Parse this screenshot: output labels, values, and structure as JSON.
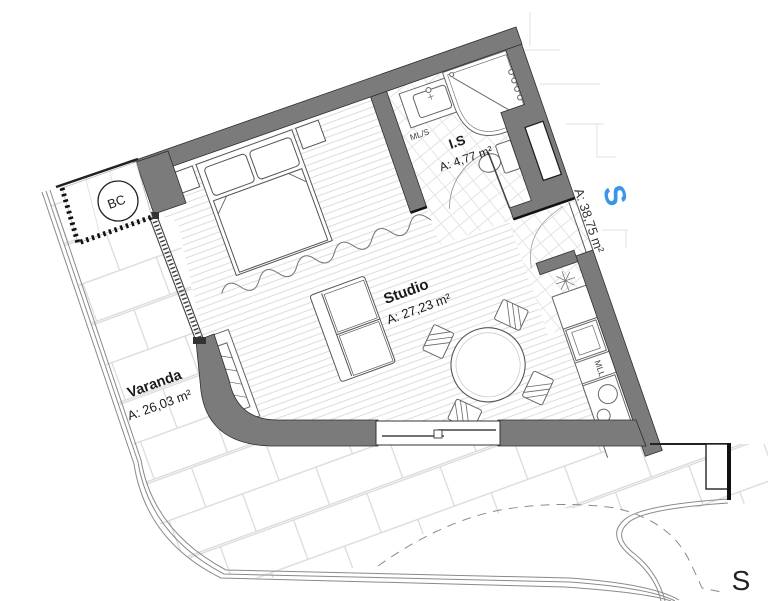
{
  "plan": {
    "rooms": {
      "studio": {
        "name": "Studio",
        "area": "A: 27,23 m²"
      },
      "bathroom": {
        "name": "I.S",
        "area": "A: 4,77 m²"
      },
      "balcony": {
        "name": "Varanda",
        "area": "A: 26,03 m²"
      }
    },
    "total_area_label": "A: 38,75 m²",
    "labels": {
      "closet": "BC",
      "washer_sink": "ML/S",
      "dishwasher": "MLL",
      "orientation_blue": "S",
      "section_marker": "S"
    },
    "colors": {
      "wall_gray": "#7b7b7b",
      "accent_blue": "#3a96e8"
    }
  }
}
